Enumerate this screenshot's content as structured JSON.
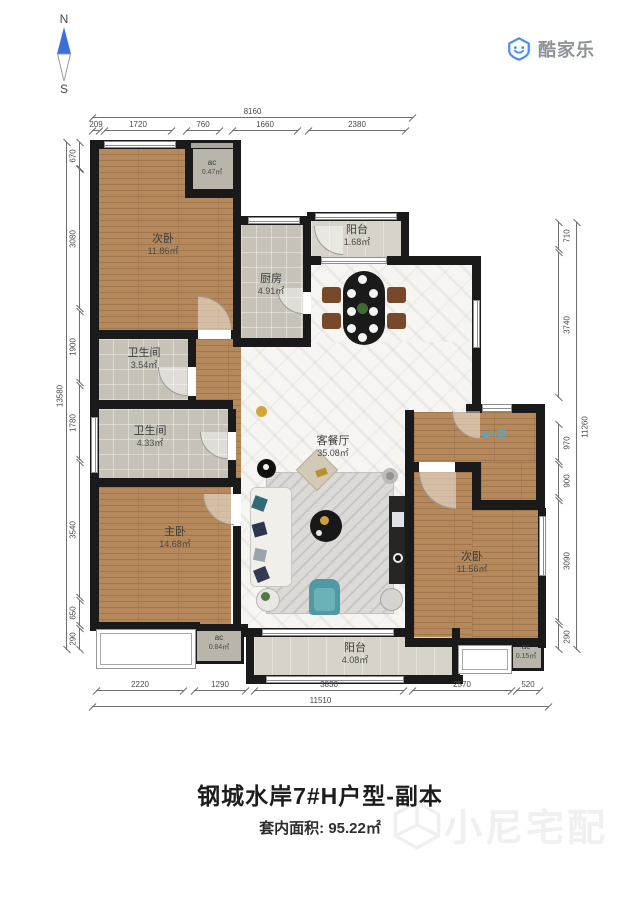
{
  "compass": {
    "north": "N",
    "south": "S"
  },
  "logo": {
    "brand": "酷家乐"
  },
  "entrance": {
    "arrow": "◀",
    "label": "入口"
  },
  "rooms": {
    "bedroom_top_left": {
      "name": "次卧",
      "area": "11.86㎡"
    },
    "ac_top": {
      "name": "ac",
      "area": "0.47㎡"
    },
    "kitchen": {
      "name": "厨房",
      "area": "4.91㎡"
    },
    "balcony_top": {
      "name": "阳台",
      "area": "1.68㎡"
    },
    "bath_upper": {
      "name": "卫生间",
      "area": "3.54㎡"
    },
    "bath_lower": {
      "name": "卫生间",
      "area": "4.33㎡"
    },
    "living": {
      "name": "客餐厅",
      "area": "35.08㎡"
    },
    "master": {
      "name": "主卧",
      "area": "14.68㎡"
    },
    "bedroom_bottom_right": {
      "name": "次卧",
      "area": "11.56㎡"
    },
    "ac_master": {
      "name": "ac",
      "area": "0.84㎡"
    },
    "balcony_bottom": {
      "name": "阳台",
      "area": "4.08㎡"
    },
    "ac_bottom_right": {
      "name": "ac",
      "area": "0.15㎡"
    }
  },
  "dimensions": {
    "top": {
      "overall": "8160",
      "segments": [
        "209",
        "1720",
        "760",
        "1660",
        "2380"
      ]
    },
    "bottom": {
      "overall": "11510",
      "segments": [
        "2220",
        "1290",
        "3830",
        "2570",
        "520"
      ]
    },
    "left": {
      "overall": "13580",
      "segments": [
        "670",
        "3080",
        "1900",
        "1780",
        "3540",
        "650",
        "290"
      ]
    },
    "right": {
      "overall": "11260",
      "segments": [
        "710",
        "3740",
        "970",
        "900",
        "3090",
        "290"
      ]
    }
  },
  "footer": {
    "title": "钢城水岸7#H户型-副本",
    "area_label": "套内面积:",
    "area_value": "95.22㎡"
  },
  "watermark": {
    "text": "小尼宅配"
  },
  "colors": {
    "wall": "#1a1a1a",
    "wood_floor": "#b5895c",
    "entry_label": "#35b3e4",
    "logo_blue": "#4a8cf7",
    "compass_blue": "#3a6fd8"
  }
}
